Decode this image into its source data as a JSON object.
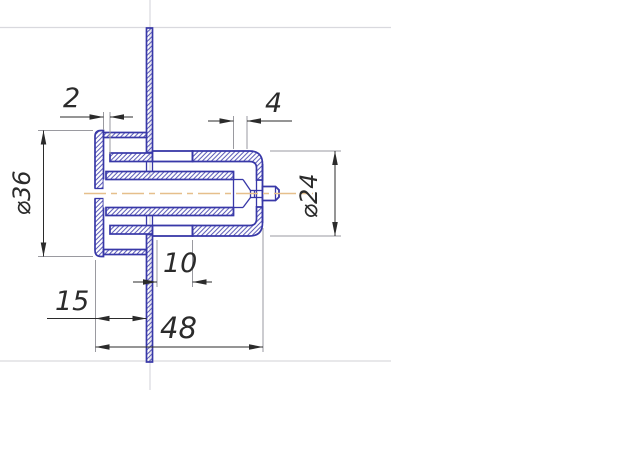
{
  "colors": {
    "part_outline": "#3838a8",
    "hatch": "#4b4bb0",
    "dimension": "#2b2b2b",
    "extension": "#9a9aa0",
    "construction": "#d9d9de",
    "centerline": "#e6bf8b",
    "background": "#ffffff"
  },
  "dims": {
    "d2": "2",
    "d4": "4",
    "d10": "10",
    "d15": "15",
    "d48": "48",
    "dia36": "⌀36",
    "dia24": "⌀24"
  }
}
